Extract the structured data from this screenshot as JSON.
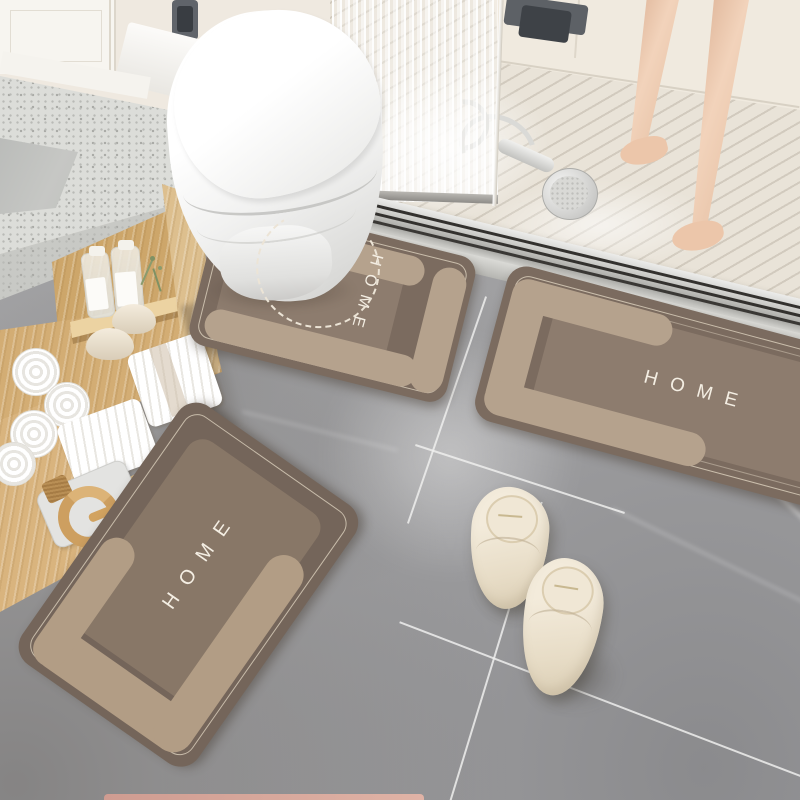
{
  "scene_title": "Bathroom with HOME bath mat set, toilet, vanity, shower and slippers",
  "mats": [
    {
      "id": "contour-toilet-mat",
      "label": "HOME"
    },
    {
      "id": "rectangle-mat-right",
      "label": "HOME"
    },
    {
      "id": "rectangle-mat-large",
      "label": "HOME"
    }
  ],
  "colors": {
    "floor": "#a5a5a7",
    "wall": "#efe9e0",
    "shower_floor": "#e9e3d8",
    "mat_base": "#7b6b5f",
    "mat_panel": "#8d7c6e",
    "mat_accent": "#b5a28d",
    "mat_text": "#f4eee3",
    "stitch": "#ece4d6",
    "counter": "#dcddd9",
    "wood": "#d9b47e",
    "towel": "#ffffff",
    "slipper": "#efe6d4",
    "skin": "#ecc9ae",
    "drain_metal": "#c6c6c2",
    "pink_mat_edge": "#d8a79b"
  }
}
